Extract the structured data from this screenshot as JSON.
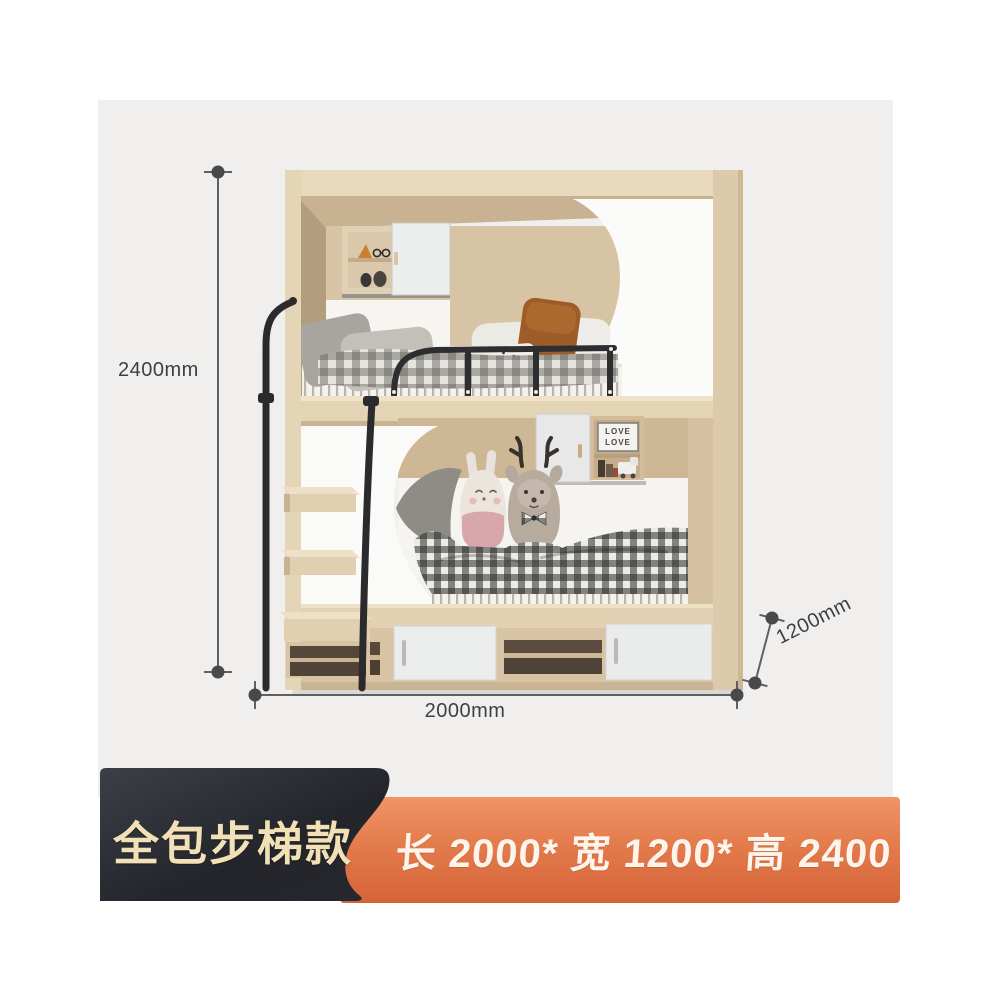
{
  "page": {
    "background": "#ffffff",
    "photo_background": "#f0efed"
  },
  "dimensions": {
    "line_color": "#5f6062",
    "text_color": "#3e3f41",
    "height": {
      "label": "2400mm"
    },
    "length": {
      "label": "2000mm"
    },
    "depth": {
      "label": "1200mm"
    }
  },
  "badges": {
    "style_badge": {
      "text": "全包步梯款",
      "background_from": "#3c3f47",
      "background_to": "#1f2126",
      "text_color": "#f2e0b6"
    },
    "size_badge": {
      "text": "长 2000* 宽 1200* 高 2400",
      "background_from": "#f09466",
      "background_to": "#d56439",
      "text_color": "#fdf5ec"
    }
  },
  "photo_decor": {
    "frame_line1": "LOVE",
    "frame_line2": "LOVE",
    "wood_color": "#d7c4a5",
    "panel_white": "#fafaf8",
    "metal_black": "#2b2b2d"
  }
}
